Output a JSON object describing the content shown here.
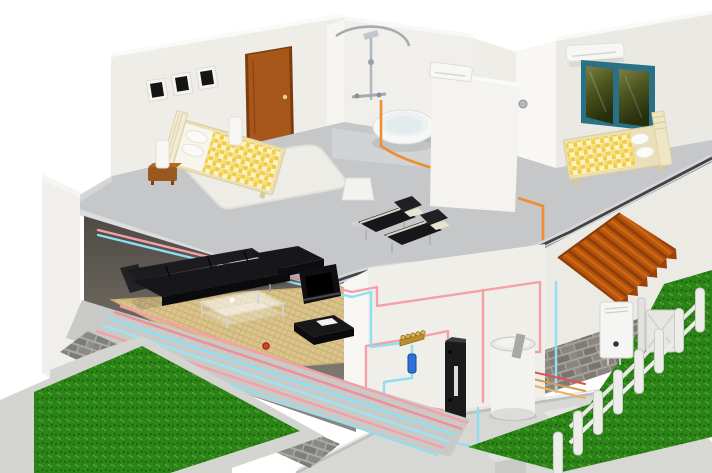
{
  "illustration": {
    "type": "3d-cutaway-house",
    "subject": "Two-story home heating and hot-water piping system",
    "rooms": [
      "master bedroom",
      "bathroom",
      "hallway",
      "second bedroom",
      "landing",
      "living room",
      "utility corner",
      "garden"
    ],
    "equipment": [
      "picture frames",
      "wooden door",
      "double bed",
      "bedside lamps",
      "nightstand",
      "area rug",
      "shower set",
      "round bathtub",
      "hall fan-coil unit",
      "bedroom ac unit",
      "teal window",
      "single bed",
      "floor lamp",
      "lounge chairs",
      "sectional sofa",
      "glass coffee table",
      "ottoman",
      "wall fireplace",
      "under-floor heating grid",
      "brass distribution manifold",
      "blue zone valve",
      "heat pump indoor unit",
      "hot water storage tank",
      "wall-hung boiler",
      "orange corrugated awning",
      "white picket fence",
      "brick foundation",
      "garden grass",
      "concrete pad",
      "hot water pipes",
      "cold water pipes",
      "orange supply pipe",
      "red shutoff valve"
    ]
  },
  "colors": {
    "background": "#ffffff",
    "wall": "#efede7",
    "wall_bright": "#f8f7f4",
    "wall_shadow": "#dedcd5",
    "floor_upper": "#c6c7c9",
    "trim_dark": "#434347",
    "parquet": "#d9c48e",
    "rug": "#edece6",
    "door": "#a8571a",
    "window_frame": "#2a7086",
    "bedding_yellow": "#f0cc48",
    "bed_frame": "#eadfb6",
    "furniture_black": "#17171a",
    "chrome": "#a4aab0",
    "pipe_hot": "#f5a0a8",
    "pipe_cold": "#8edff2",
    "pipe_orange": "#ef8e2e",
    "pipe_red": "#e05050",
    "pipe_tan": "#d89a50",
    "awning": "#b4540e",
    "brick": "#a9a9a5",
    "grass": "#2c8318",
    "concrete": "#d7d7d3",
    "tank_white": "#f2f2f0",
    "heatpump_black": "#1b1b1e",
    "boiler_white": "#f5f5f3",
    "manifold_brass": "#b8902e",
    "valve_blue": "#2f6fd8",
    "fence_white": "#ecece8"
  }
}
